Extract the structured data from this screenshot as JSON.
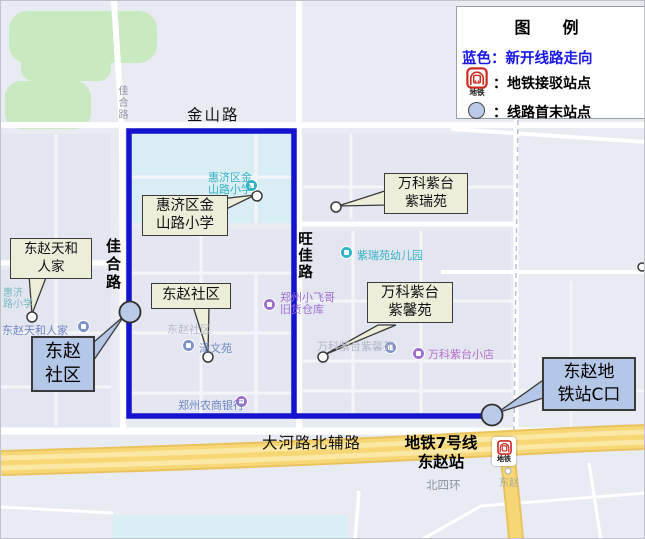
{
  "legend": {
    "title": "图　例",
    "route_line_label": "蓝色：新开线路走向",
    "metro_item_label": "：地铁接驳站点",
    "terminal_item_label": "：线路首末站点",
    "metro_icon_text": "地铁"
  },
  "roads": {
    "jinshan": "金山路",
    "jiahe_small": "佳合路",
    "jiahe": "佳合路",
    "wangjia": "旺佳路",
    "dahe_north": "大河路北辅路",
    "beisihuan": "北四环",
    "dongzhao_faint": "东赵"
  },
  "callouts": {
    "tianhe": {
      "line1": "东赵天和",
      "line2": "人家"
    },
    "school": {
      "line1": "惠济区金",
      "line2": "山路小学"
    },
    "shequ": {
      "text": "东赵社区"
    },
    "zirui": {
      "line1": "万科紫台",
      "line2": "紫瑞苑"
    },
    "zixin": {
      "line1": "万科紫台",
      "line2": "紫馨苑"
    }
  },
  "terminal_boxes": {
    "shequ": {
      "line1": "东赵",
      "line2": "社区"
    },
    "metro_exit": {
      "line1": "东赵地",
      "line2": "铁站C口"
    }
  },
  "station": {
    "line1": "地铁7号线",
    "line2": "东赵站",
    "metro_icon_text": "地铁"
  },
  "pois": {
    "school_map": {
      "line1": "惠济区金",
      "line2": "山路小学"
    },
    "school_left": {
      "line1": "惠济",
      "line2": "路小学"
    },
    "tianhe_map": "东赵天和人家",
    "shequ_faint": "东赵社区",
    "zewenyuan": "泽文苑",
    "bank": "郑州农商银行",
    "feige": {
      "line1": "郑州小飞哥",
      "line2": "旧货仓库"
    },
    "kindergarten": "紫瑞苑幼儿园",
    "zixin_map": "万科紫台紫馨苑",
    "store": "万科紫台小店"
  },
  "colors": {
    "route_blue": "#1414cf",
    "terminal_fill": "#b9cbe9",
    "callout_fill": "#edeeda",
    "bluebox_fill": "#b5c7e6",
    "legend_blue_text": "#1a18e8",
    "metro_red": "#cc2a22",
    "highway_yellow": "#f7d775",
    "map_background": "#e9ebf3",
    "park_green": "#c9e9c1",
    "school_block": "#d9edf5"
  }
}
